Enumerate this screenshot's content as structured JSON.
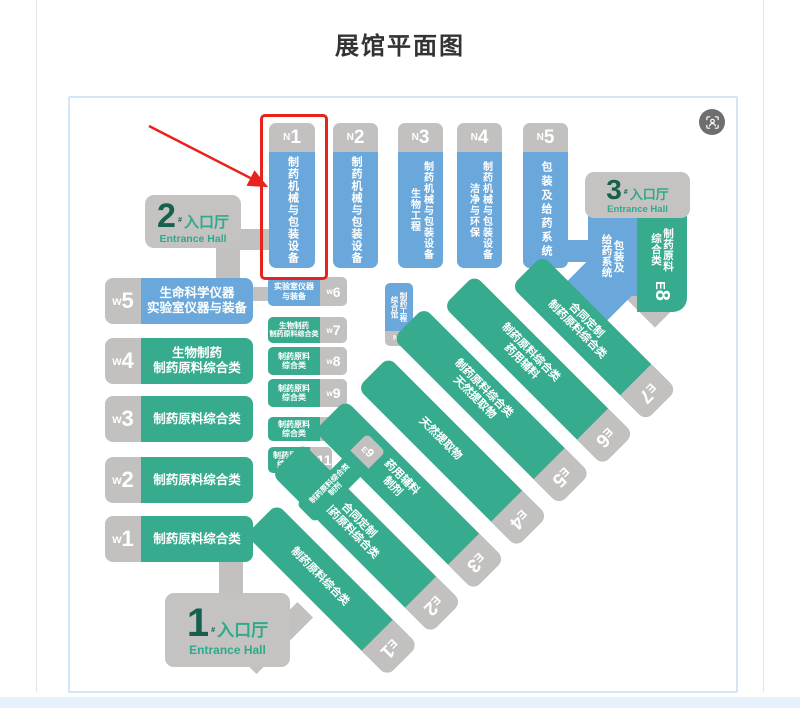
{
  "page": {
    "title": "展馆平面图"
  },
  "icons": {
    "badge": "scan-person-icon"
  },
  "colors": {
    "hall_blue": "#6aa7da",
    "hall_green": "#36ab8e",
    "hall_gray": "#c2c1c0",
    "highlight_red": "#e8231d",
    "entrance_number_green": "#17604e",
    "entrance_text_green": "#2fa98c",
    "card_border_blue": "#d3e6f8"
  },
  "annotation": {
    "highlight_target": "N1"
  },
  "entrances": {
    "e1": {
      "num": "1",
      "hash": "#",
      "cn": "入口厅",
      "en": "Entrance Hall"
    },
    "e2": {
      "num": "2",
      "hash": "#",
      "cn": "入口厅",
      "en": "Entrance Hall"
    },
    "e3": {
      "num": "3",
      "hash": "#",
      "cn": "入口厅",
      "en": "Entrance Hall"
    }
  },
  "n_halls": [
    {
      "prefix": "N",
      "num": "1",
      "lines": [
        "制药机械与包装设备"
      ]
    },
    {
      "prefix": "N",
      "num": "2",
      "lines": [
        "制药机械与包装设备"
      ]
    },
    {
      "prefix": "N",
      "num": "3",
      "lines": [
        "制药机械与包装设备",
        "生物工程"
      ]
    },
    {
      "prefix": "N",
      "num": "4",
      "lines": [
        "制药机械与包装设备",
        "洁净与环保"
      ]
    },
    {
      "prefix": "N",
      "num": "5",
      "lines": [
        "包装及给药系统"
      ]
    },
    {
      "prefix": "N",
      "num": "6",
      "lines": [
        "制药工程",
        "综合馆"
      ]
    }
  ],
  "w_halls": [
    {
      "prefix": "w",
      "num": "5",
      "lines": [
        "生命科学仪器",
        "实验室仪器与装备"
      ]
    },
    {
      "prefix": "w",
      "num": "4",
      "lines": [
        "生物制药",
        "制药原料综合类"
      ]
    },
    {
      "prefix": "w",
      "num": "3",
      "lines": [
        "制药原料综合类"
      ]
    },
    {
      "prefix": "w",
      "num": "2",
      "lines": [
        "制药原料综合类"
      ]
    },
    {
      "prefix": "w",
      "num": "1",
      "lines": [
        "制药原料综合类"
      ]
    }
  ],
  "w_small": [
    {
      "prefix": "w",
      "num": "6",
      "lines": [
        "实验室仪器",
        "与装备"
      ]
    },
    {
      "prefix": "w",
      "num": "7",
      "lines": [
        "生物制药",
        "制药原料综合类"
      ]
    },
    {
      "prefix": "w",
      "num": "8",
      "lines": [
        "制药原料",
        "综合类"
      ]
    },
    {
      "prefix": "w",
      "num": "9",
      "lines": [
        "制药原料",
        "综合类"
      ]
    },
    {
      "prefix": "w",
      "num": "10",
      "lines": [
        "制药原料",
        "综合类"
      ]
    },
    {
      "prefix": "w",
      "num": "11",
      "lines": [
        "制药原料",
        "综合类"
      ]
    }
  ],
  "e_halls": [
    {
      "prefix": "E",
      "num": "1",
      "lines": [
        "制药原料综合类"
      ]
    },
    {
      "prefix": "E",
      "num": "2",
      "lines": [
        "合同定制",
        "制药原料综合类"
      ]
    },
    {
      "prefix": "E",
      "num": "3",
      "lines": [
        "药用辅料",
        "制剂"
      ]
    },
    {
      "prefix": "E",
      "num": "4",
      "lines": [
        "天然提取物"
      ]
    },
    {
      "prefix": "E",
      "num": "5",
      "lines": [
        "制药原料综合类",
        "天然提取物"
      ]
    },
    {
      "prefix": "E",
      "num": "6",
      "lines": [
        "制药原料综合类",
        "药用辅料"
      ]
    },
    {
      "prefix": "E",
      "num": "7",
      "lines": [
        "合同定制",
        "制药原料综合类"
      ]
    }
  ],
  "e8": {
    "prefix": "E",
    "num": "8",
    "blue_lines": [
      "包装及",
      "给药系统"
    ],
    "green_lines": [
      "制药原料",
      "综合类"
    ]
  },
  "e9": {
    "prefix": "E",
    "num": "9",
    "lines": [
      "制药原料综合类",
      "制剂"
    ]
  }
}
